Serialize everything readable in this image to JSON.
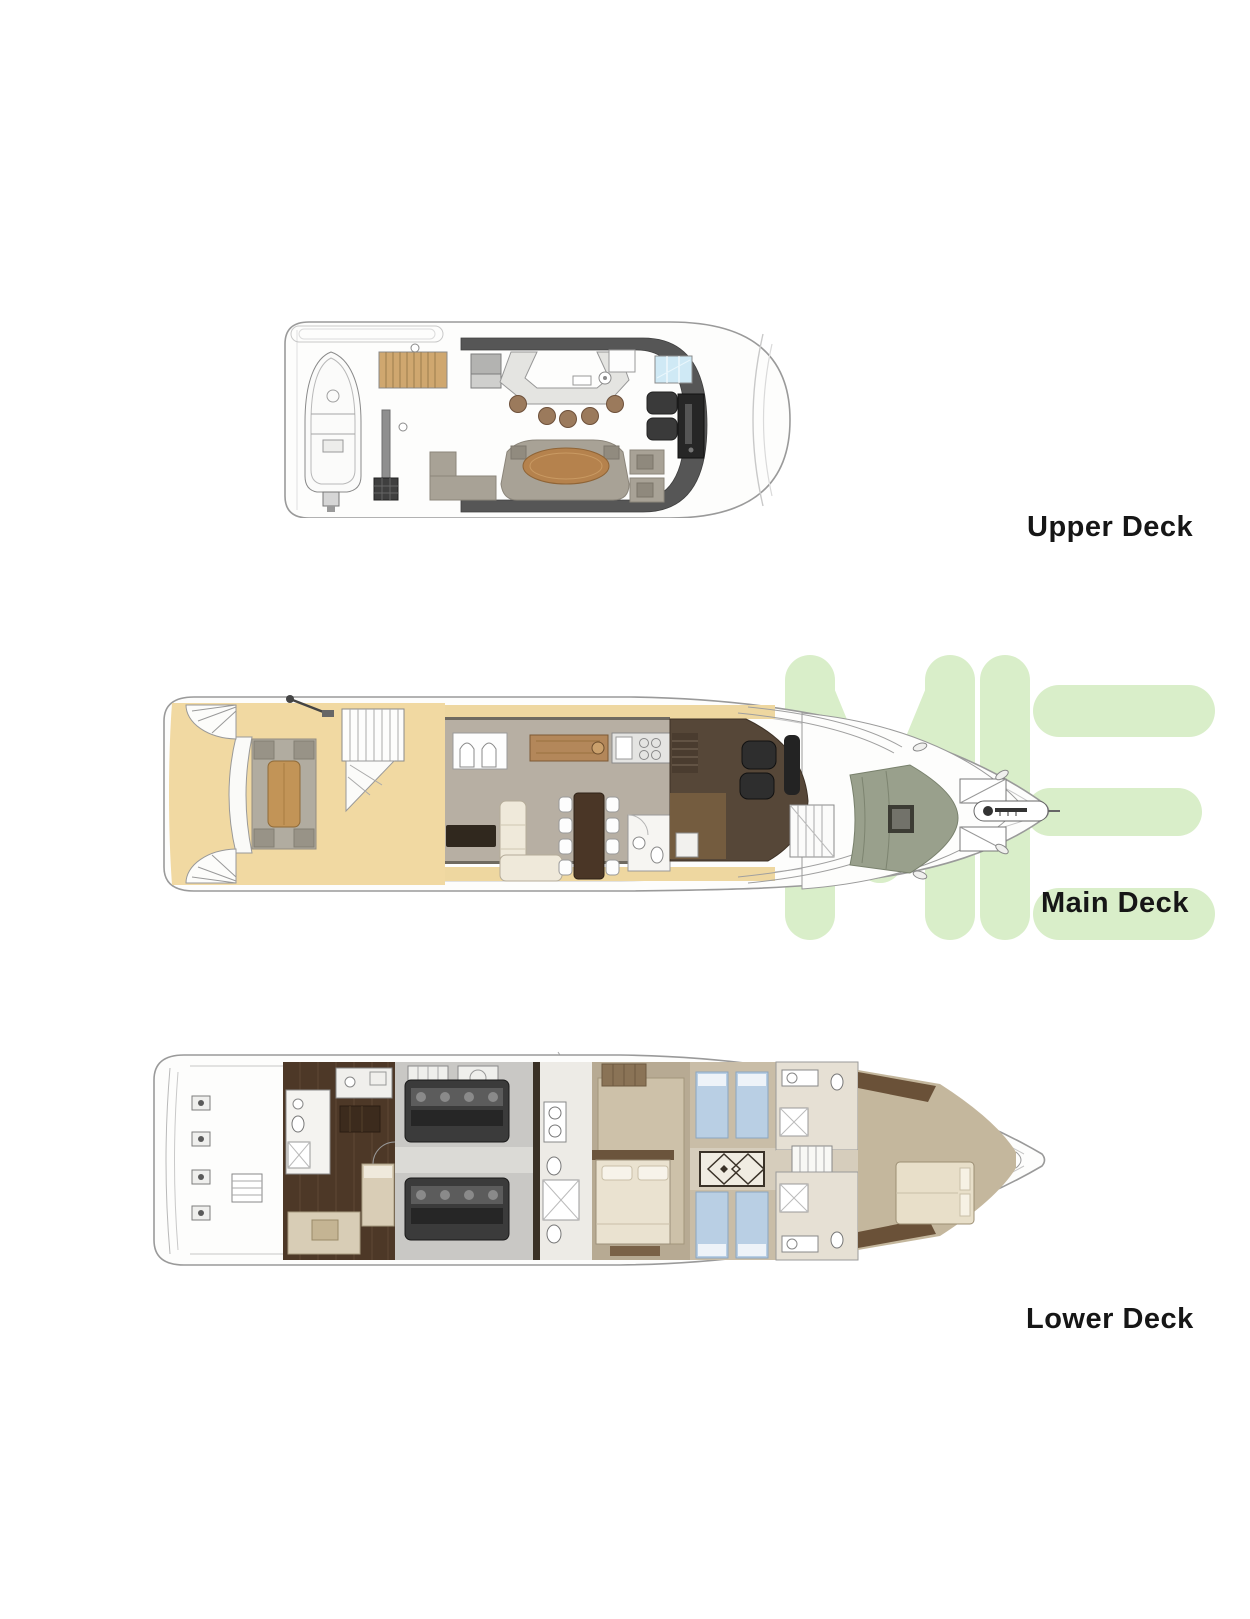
{
  "page": {
    "background": "#ffffff"
  },
  "watermark": {
    "letters": "ME",
    "color": "#d9eec9"
  },
  "decks": [
    {
      "id": "upper-deck",
      "label": "Upper Deck"
    },
    {
      "id": "main-deck",
      "label": "Main Deck"
    },
    {
      "id": "lower-deck",
      "label": "Lower Deck"
    }
  ],
  "label_color": "#161616"
}
